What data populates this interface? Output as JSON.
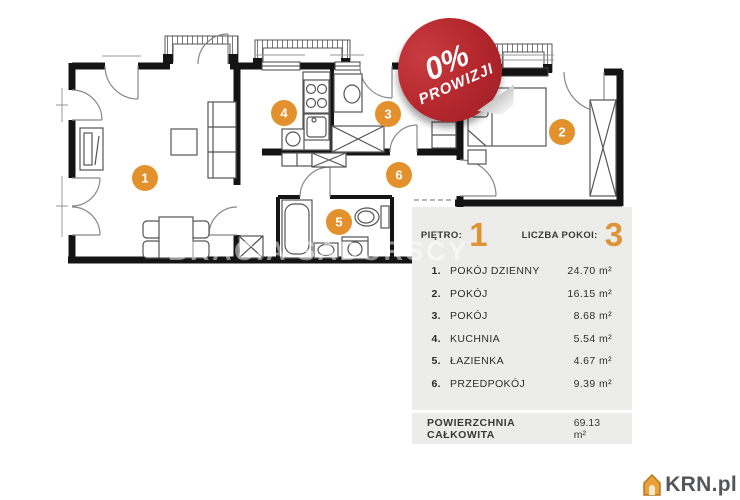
{
  "badge": {
    "percent": "0%",
    "label": "PROWIZJI"
  },
  "watermark": "BRACIA SADURSCY",
  "panel": {
    "floor_label": "PIĘTRO:",
    "floor_value": "1",
    "rooms_count_label": "LICZBA POKOI:",
    "rooms_count_value": "3",
    "rooms": [
      {
        "no": "1.",
        "name": "POKÓJ DZIENNY",
        "area": "24.70 m²"
      },
      {
        "no": "2.",
        "name": "POKÓJ",
        "area": "16.15 m²"
      },
      {
        "no": "3.",
        "name": "POKÓJ",
        "area": "8.68 m²"
      },
      {
        "no": "4.",
        "name": "KUCHNIA",
        "area": "5.54 m²"
      },
      {
        "no": "5.",
        "name": "ŁAZIENKA",
        "area": "4.67 m²"
      },
      {
        "no": "6.",
        "name": "PRZEDPOKÓJ",
        "area": "9.39 m²"
      }
    ],
    "total_label": "POWIERZCHNIA CAŁKOWITA",
    "total_value": "69.13 m²"
  },
  "plan": {
    "markers": [
      "1",
      "2",
      "3",
      "4",
      "5",
      "6"
    ]
  },
  "logo": {
    "text": "KRN.pl"
  },
  "colors": {
    "accent_orange": "#E2912C",
    "badge_red": "#B2262C",
    "panel_bg": "#ECECEA",
    "wall_black": "#141414"
  }
}
